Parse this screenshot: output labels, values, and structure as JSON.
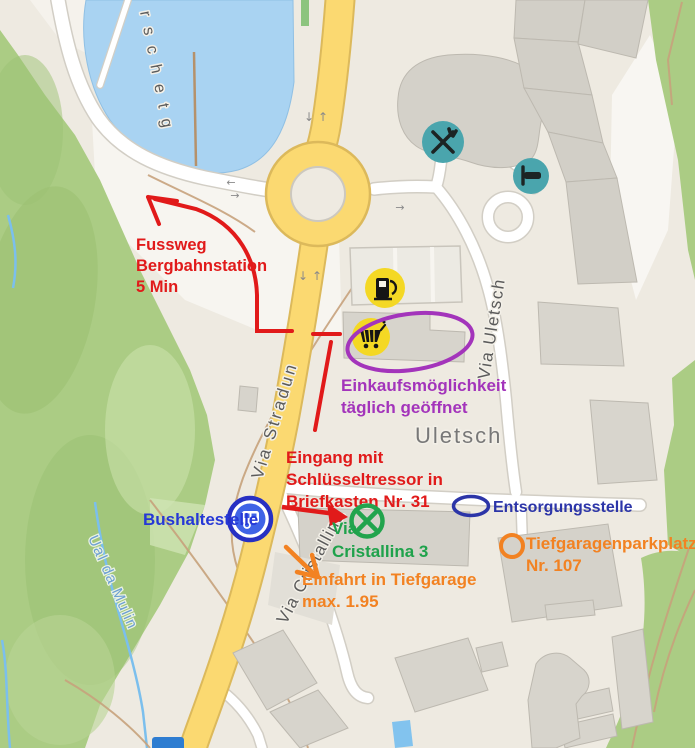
{
  "map": {
    "type": "annotated-street-map",
    "street_labels": {
      "surschetg": "rschetg",
      "via_stradun": "Via Stradun",
      "via_cristallina": "Via Cristallina",
      "via_uletsch": "Via Uletsch",
      "district": "Uletsch",
      "stream": "Ual da Mulin"
    },
    "direction_arrows": {
      "up": "↑",
      "down": "↓",
      "left": "←",
      "right": "→"
    },
    "icons": {
      "restaurant": "restaurant-icon",
      "hotel": "hotel-bed-icon",
      "fuel": "fuel-station-icon",
      "shopping": "shopping-cart-icon",
      "bus": "bus-stop-icon",
      "marker": "crossed-circle-marker-icon",
      "shield": "route-shield"
    }
  },
  "annotations": {
    "fussweg": {
      "line1": "Fussweg",
      "line2": "Bergbahnstation",
      "line3": "5 Min"
    },
    "eingang": {
      "line1": "Eingang mit",
      "line2": "Schlüsseltressor in",
      "line3": "Briefkasten Nr. 31"
    },
    "einkauf": {
      "line1": "Einkaufsmöglichkeit",
      "line2": "täglich geöffnet"
    },
    "bushaltestelle": {
      "label": "Bushaltestelle"
    },
    "via_cristallina_3": {
      "line1": "Via",
      "line2": "Cristallina 3"
    },
    "entsorgungsstelle": {
      "label": "Entsorgungsstelle"
    },
    "tiefgarage_parkplatz": {
      "line1": "Tiefgaragenparkplatz",
      "line2": "Nr. 107"
    },
    "tiefgarage_einfahrt": {
      "line1": "Einfahrt in Tiefgarage",
      "line2": "max. 1.95"
    }
  },
  "colors": {
    "annotation_red": "#e11a1a",
    "annotation_purple": "#a334bb",
    "bus_label_blue": "#2638d6",
    "entsorgung_blue": "#2c35a8",
    "annotation_green": "#1fa24b",
    "annotation_orange": "#f28222",
    "poi_teal": "#4aa5ad",
    "poi_yellow": "#f4d824",
    "bus_icon_blue": "#3f63e6",
    "road_yellow": "#fbd971",
    "water_blue": "#a9d3f2",
    "forest_green": "#abcc84"
  }
}
